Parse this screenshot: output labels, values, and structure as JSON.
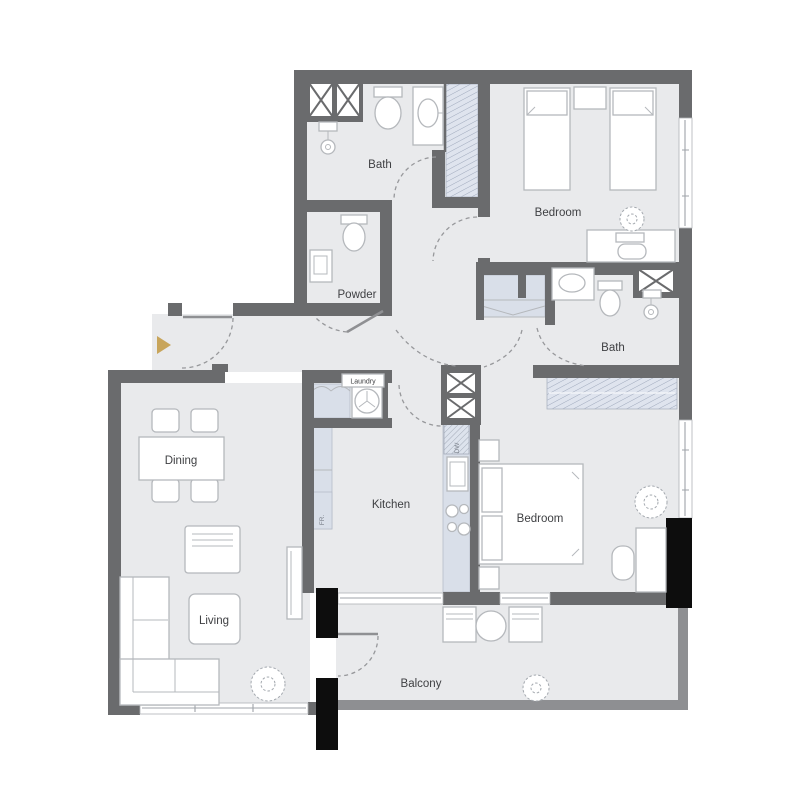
{
  "floorplan": {
    "labels": {
      "bath_top": "Bath",
      "bedroom_top": "Bedroom",
      "powder": "Powder",
      "bath_right": "Bath",
      "laundry": "Laundry",
      "dining": "Dining",
      "kitchen": "Kitchen",
      "living": "Living",
      "bedroom_right": "Bedroom",
      "balcony": "Balcony",
      "dishwasher": "DW",
      "fridge": "FR."
    },
    "colors": {
      "wall": "#6a6b6d",
      "balcony_wall": "#8e8f92",
      "floor": "#e9eaec",
      "closet": "#d9dfe9",
      "column": "#0d0d0d",
      "entry_arrow": "#c8a55b",
      "furniture_stroke": "#b5b8bc",
      "label_text": "#3f4043",
      "background": "#ffffff"
    }
  }
}
